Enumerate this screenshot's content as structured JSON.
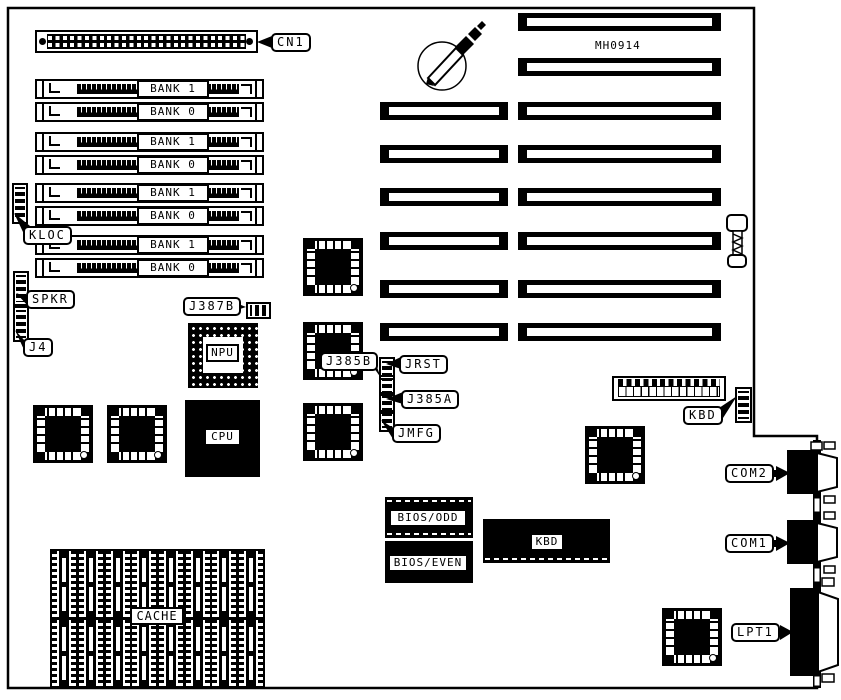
{
  "board": {
    "model_text": "MH0914"
  },
  "memory": {
    "banks": [
      {
        "label": "BANK 1"
      },
      {
        "label": "BANK 0"
      },
      {
        "label": "BANK 1"
      },
      {
        "label": "BANK 0"
      },
      {
        "label": "BANK 1"
      },
      {
        "label": "BANK 0"
      },
      {
        "label": "BANK 1"
      },
      {
        "label": "BANK 0"
      }
    ]
  },
  "callouts": {
    "cn1": "CN1",
    "kloc": "KLOC",
    "spkr": "SPKR",
    "j4": "J4",
    "j387b": "J387B",
    "j385b": "J385B",
    "jrst": "JRST",
    "j385a": "J385A",
    "jmfg": "JMFG",
    "kbd": "KBD",
    "com2": "COM2",
    "com1": "COM1",
    "lpt1": "LPT1"
  },
  "chips": {
    "npu": "NPU",
    "cpu": "CPU",
    "bios_odd": "BIOS/ODD",
    "bios_even": "BIOS/EVEN",
    "kbd": "KBD",
    "cache": "CACHE"
  },
  "colors": {
    "ink": "#000000",
    "paper": "#ffffff"
  }
}
